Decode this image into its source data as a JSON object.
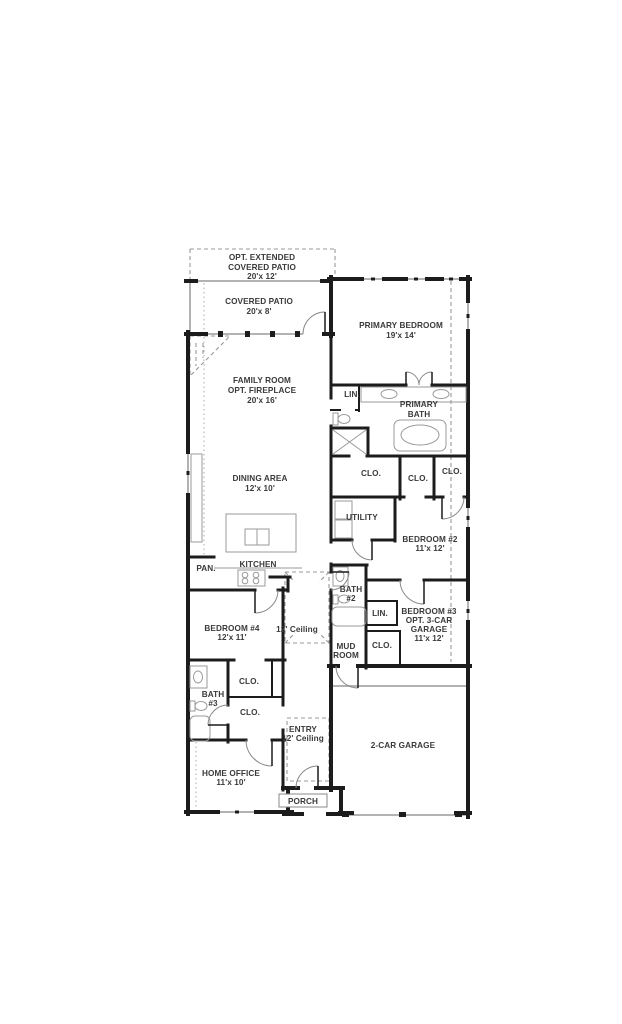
{
  "colors": {
    "wall": "#1c1c1c",
    "window": "#9a9a9a",
    "fixture": "#9a9a9a",
    "dashed_guide": "#999999",
    "text": "#3a3a3a",
    "background": "#ffffff"
  },
  "labels": {
    "opt_patio": [
      "OPT. EXTENDED",
      "COVERED PATIO",
      "20'x 12'"
    ],
    "covered_patio": [
      "COVERED PATIO",
      "20'x 8'"
    ],
    "primary_bedroom": [
      "PRIMARY BEDROOM",
      "19'x 14'"
    ],
    "family_room": [
      "FAMILY ROOM",
      "OPT. FIREPLACE",
      "20'x 16'"
    ],
    "lin_primary": "LIN.",
    "primary_bath": [
      "PRIMARY",
      "BATH"
    ],
    "clo_primary_left": "CLO.",
    "clo_primary_mid": "CLO.",
    "clo_primary_right": "CLO.",
    "dining": [
      "DINING AREA",
      "12'x 10'"
    ],
    "utility": "UTILITY",
    "bedroom2": [
      "BEDROOM #2",
      "11'x 12'"
    ],
    "kitchen": "KITCHEN",
    "pantry": "PAN.",
    "bath2": [
      "BATH",
      "#2"
    ],
    "lin_hall": "LIN.",
    "bedroom3": [
      "BEDROOM #3",
      "OPT. 3-CAR",
      "GARAGE",
      "11'x 12'"
    ],
    "bedroom4": [
      "BEDROOM #4",
      "12'x 11'"
    ],
    "hall_ceiling": "12' Ceiling",
    "mud_room": [
      "MUD",
      "ROOM"
    ],
    "clo_mud": "CLO.",
    "clo_bedroom4": "CLO.",
    "bath3": [
      "BATH",
      "#3"
    ],
    "clo_entry": "CLO.",
    "entry": [
      "ENTRY",
      "12' Ceiling"
    ],
    "garage": "2-CAR GARAGE",
    "home_office": [
      "HOME OFFICE",
      "11'x 10'"
    ],
    "porch": "PORCH"
  }
}
